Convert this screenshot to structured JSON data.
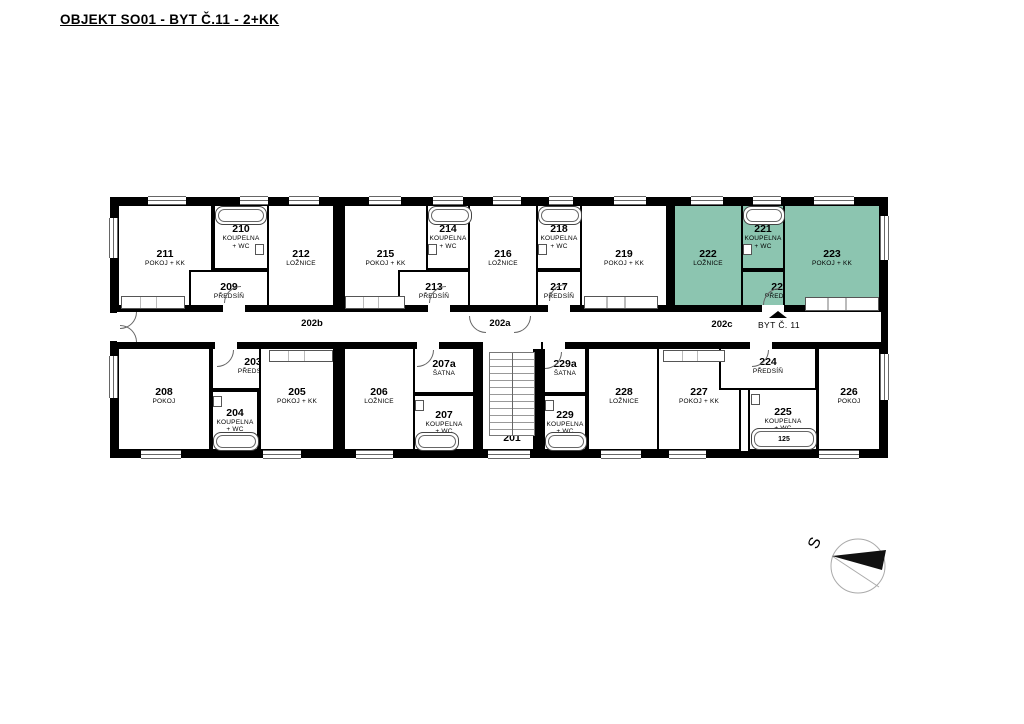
{
  "title": "OBJEKT SO01 - BYT Č.11 - 2+KK",
  "colors": {
    "highlight": "#8cc5b0",
    "wall": "#000000"
  },
  "rooms": [
    {
      "number": "211",
      "label": "POKOJ + KK"
    },
    {
      "number": "210",
      "label": "KOUPELNA\n+ WC"
    },
    {
      "number": "209",
      "label": "PŘEDSÍŇ"
    },
    {
      "number": "212",
      "label": "LOŽNICE"
    },
    {
      "number": "215",
      "label": "POKOJ + KK"
    },
    {
      "number": "214",
      "label": "KOUPELNA\n+ WC"
    },
    {
      "number": "213",
      "label": "PŘEDSÍŇ"
    },
    {
      "number": "216",
      "label": "LOŽNICE"
    },
    {
      "number": "218",
      "label": "KOUPELNA\n+ WC"
    },
    {
      "number": "217",
      "label": "PŘEDSÍŇ"
    },
    {
      "number": "219",
      "label": "POKOJ + KK"
    },
    {
      "number": "222",
      "label": "LOŽNICE",
      "highlighted": true
    },
    {
      "number": "221",
      "label": "KOUPELNA\n+ WC",
      "highlighted": true
    },
    {
      "number": "220",
      "label": "PŘEDSÍŇ",
      "highlighted": true
    },
    {
      "number": "223",
      "label": "POKOJ + KK",
      "highlighted": true
    },
    {
      "number": "208",
      "label": "POKOJ"
    },
    {
      "number": "203",
      "label": "PŘEDSÍŇ"
    },
    {
      "number": "204",
      "label": "KOUPELNA\n+ WC"
    },
    {
      "number": "205",
      "label": "POKOJ + KK"
    },
    {
      "number": "206",
      "label": "LOŽNICE"
    },
    {
      "number": "207a",
      "label": "ŠATNA"
    },
    {
      "number": "207",
      "label": "KOUPELNA\n+ WC"
    },
    {
      "number": "201",
      "label": ""
    },
    {
      "number": "229a",
      "label": "ŠATNA"
    },
    {
      "number": "229",
      "label": "KOUPELNA\n+ WC"
    },
    {
      "number": "228",
      "label": "LOŽNICE"
    },
    {
      "number": "227",
      "label": "POKOJ + KK"
    },
    {
      "number": "224",
      "label": "PŘEDSÍŇ"
    },
    {
      "number": "225",
      "label": "KOUPELNA\n+ WC"
    },
    {
      "number": "226",
      "label": "POKOJ"
    }
  ],
  "corridor": {
    "segment_left": "202b",
    "segment_center": "202a",
    "segment_right": "202c",
    "apartment_callout": "BYT Č. 11"
  },
  "fixtures": {
    "tub_label": "125"
  },
  "compass": {
    "north_label": "S"
  }
}
